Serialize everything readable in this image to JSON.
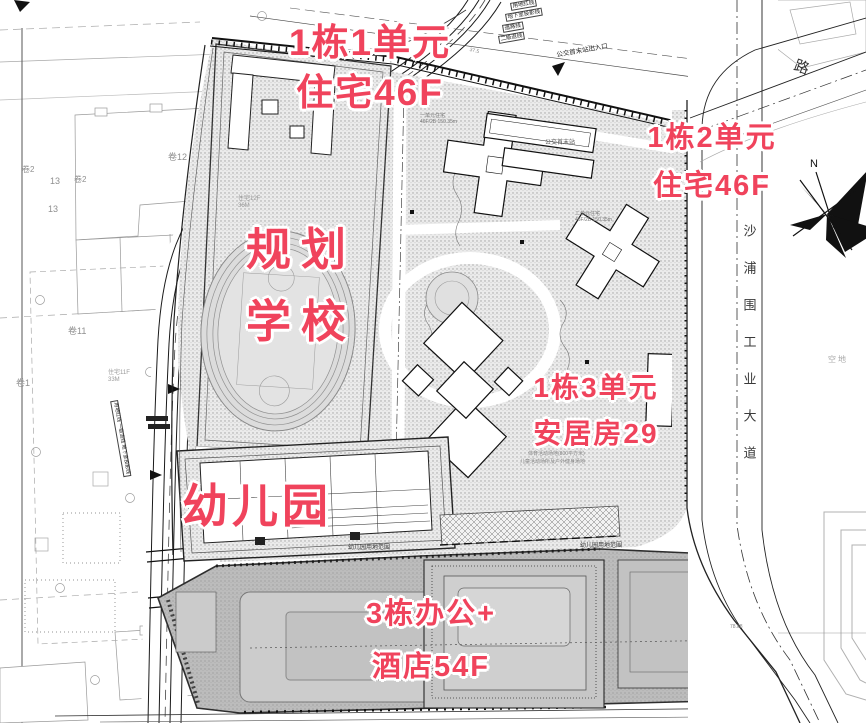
{
  "annotations": {
    "unit1": {
      "line1": "1栋1单元",
      "line2": "住宅46F"
    },
    "unit2": {
      "line1": "1栋2单元",
      "line2": "住宅46F"
    },
    "school": {
      "line1": "规划",
      "line2": "学校"
    },
    "unit3": {
      "line1": "1栋3单元",
      "line2": "安居房29"
    },
    "kindergarten": {
      "line1": "幼儿园"
    },
    "office": {
      "line1": "3栋办公+",
      "line2": "酒店54F"
    }
  },
  "colors": {
    "annotation_red": "#f0435c",
    "drawing_line": "#141414",
    "context_gray": "#a9a9a9",
    "site_fill": "#ebebeb",
    "podium_fill": "#bcbcbc"
  },
  "map_labels": {
    "items": [
      {
        "n": "road-name-shapuwei",
        "t": "沙浦围工业大道",
        "x": 741,
        "y": 224,
        "s": 13,
        "v": true,
        "ls": 24,
        "c": "#3a3a3a"
      },
      {
        "n": "road-label-lu",
        "t": "路",
        "x": 797,
        "y": 58,
        "s": 15,
        "r": 20,
        "c": "#333333"
      },
      {
        "n": "empty-lot-label",
        "t": "空地",
        "x": 828,
        "y": 356,
        "s": 8,
        "ls": 2,
        "c": "#a8a8a8"
      },
      {
        "n": "north-label",
        "t": "N",
        "x": 810,
        "y": 158,
        "s": 11,
        "c": "#111111"
      },
      {
        "n": "block-12-label",
        "t": "卷12",
        "x": 168,
        "y": 152,
        "s": 9,
        "c": "#8f8f8f"
      },
      {
        "n": "block-2a-label",
        "t": "卷2",
        "x": 22,
        "y": 166,
        "s": 8,
        "c": "#8f8f8f"
      },
      {
        "n": "block-13a-label",
        "t": "13",
        "x": 50,
        "y": 176,
        "s": 9,
        "c": "#8f8f8f"
      },
      {
        "n": "block-2b-label",
        "t": "卷2",
        "x": 74,
        "y": 176,
        "s": 8,
        "c": "#8f8f8f"
      },
      {
        "n": "block-13b-label",
        "t": "13",
        "x": 48,
        "y": 204,
        "s": 9,
        "c": "#8f8f8f"
      },
      {
        "n": "block-11-label",
        "t": "卷11",
        "x": 68,
        "y": 326,
        "s": 9,
        "c": "#8f8f8f"
      },
      {
        "n": "block-1-label",
        "t": "卷1",
        "x": 16,
        "y": 378,
        "s": 9,
        "c": "#8f8f8f"
      },
      {
        "n": "resid-12f-label",
        "t": "住宅12F 36M",
        "x": 238,
        "y": 196,
        "s": 6,
        "c": "#9a9a9a",
        "w": 30
      },
      {
        "n": "resid-11f-label",
        "t": "住宅11F 33M",
        "x": 108,
        "y": 370,
        "s": 6,
        "c": "#9a9a9a",
        "w": 30
      },
      {
        "n": "line-label-yongdi",
        "t": "用地红线",
        "x": 510,
        "y": 3,
        "s": 5.5,
        "r": -10,
        "b": true,
        "c": "#222222"
      },
      {
        "n": "line-label-dixiashi",
        "t": "地下室投影线",
        "x": 505,
        "y": 14,
        "s": 5.5,
        "r": -10,
        "b": true,
        "c": "#222222"
      },
      {
        "n": "line-label-daolu",
        "t": "道路线",
        "x": 502,
        "y": 25,
        "s": 5.5,
        "r": -10,
        "b": true,
        "c": "#222222"
      },
      {
        "n": "line-label-tuixian",
        "t": "二级退线",
        "x": 498,
        "y": 36,
        "s": 5.5,
        "r": -10,
        "b": true,
        "c": "#222222"
      },
      {
        "n": "bus-entrance-label",
        "t": "公交首末站出入口",
        "x": 556,
        "y": 52,
        "s": 6.5,
        "r": -10,
        "c": "#222222"
      },
      {
        "n": "bus-station-label",
        "t": "公交首末站",
        "x": 545,
        "y": 140,
        "s": 6,
        "c": "#555555"
      },
      {
        "n": "tower1-spec-label",
        "t": "一单元住宅 46F/2B 150.35m",
        "x": 420,
        "y": 114,
        "s": 5,
        "c": "#777777",
        "w": 42
      },
      {
        "n": "tower2-spec-label",
        "t": "二单元住宅 46F/2B 150.35m",
        "x": 575,
        "y": 212,
        "s": 5,
        "c": "#777777",
        "w": 42
      },
      {
        "n": "kg-range-label-1",
        "t": "幼儿园用地范围",
        "x": 348,
        "y": 545,
        "s": 6,
        "c": "#333333"
      },
      {
        "n": "kg-range-label-2",
        "t": "幼儿园用地范围",
        "x": 580,
        "y": 543,
        "s": 6,
        "c": "#333333"
      },
      {
        "n": "activity-note-1",
        "t": "体育活动场地(800平方米)",
        "x": 528,
        "y": 452,
        "s": 5,
        "c": "#888888"
      },
      {
        "n": "activity-note-2",
        "t": "儿童活动场所及户外健身场地",
        "x": 520,
        "y": 460,
        "s": 5,
        "c": "#888888"
      },
      {
        "n": "dim-7888-label",
        "t": "78.88",
        "x": 730,
        "y": 625,
        "s": 5,
        "c": "#888888"
      },
      {
        "n": "dim-375-label",
        "t": "37.5",
        "x": 470,
        "y": 48,
        "s": 5,
        "r": 13,
        "c": "#888888"
      },
      {
        "n": "left-line-stack-label",
        "t": "用地红线 一级退线 地下室投影线",
        "x": 118,
        "y": 400,
        "s": 5,
        "r": 80,
        "b": true,
        "c": "#222222"
      }
    ]
  }
}
